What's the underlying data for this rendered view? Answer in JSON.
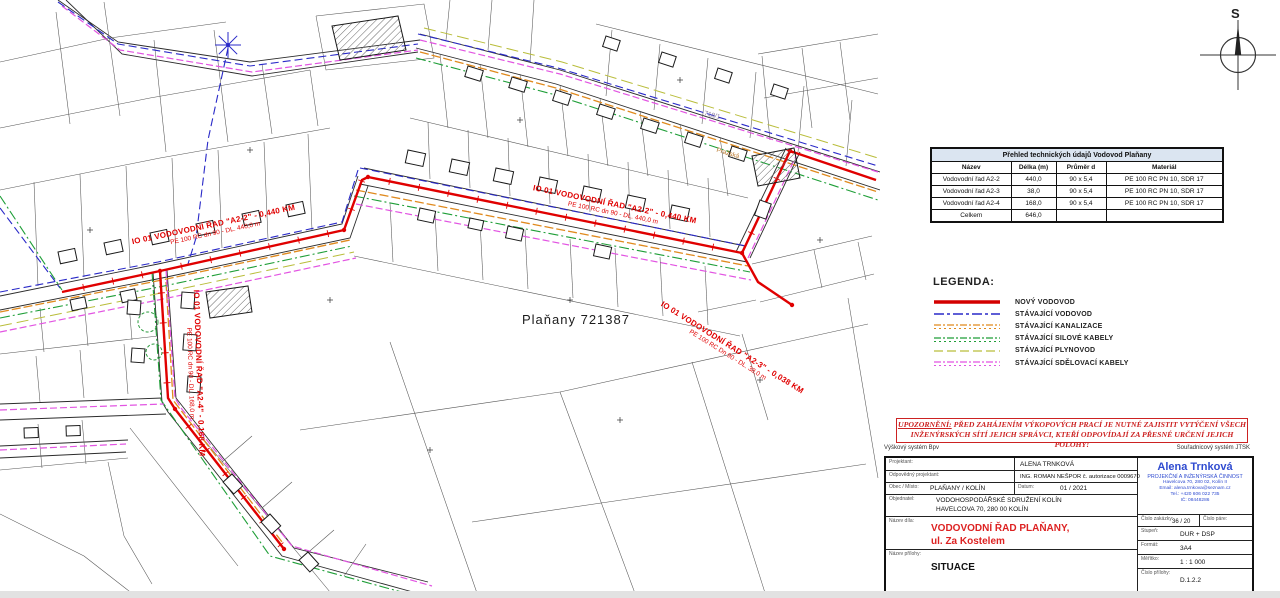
{
  "map": {
    "area_label": "Plaňany 721387",
    "street_label": "Pražská",
    "parcel_number": "718/1",
    "compass_letter": "S",
    "route_labels": [
      {
        "line1": "IO 01 VODOVODNÍ ŘAD \"A2-2\" - 0,440 KM",
        "line2": "PE 100 RC dn 90 - DL. 440,0 m"
      },
      {
        "line1": "IO 01 VODOVODNÍ ŘAD \"A2-2\" - 0,440 KM",
        "line2": "PE 100 RC dn 90 - DL. 440,0 m"
      },
      {
        "line1": "IO 01 VODOVODNÍ ŘAD \"A2-3\" - 0,038 KM",
        "line2": "PE 100 RC Dn 90 - DL. 38,0 m"
      },
      {
        "line1": "IO 01 VODOVODNÍ ŘAD \"A2-4\" - 0,168 KM",
        "line2": "PE 100 RC dn 90 - DL. 168,0 m"
      }
    ]
  },
  "tech_table": {
    "title": "Přehled technických údajů Vodovod Plaňany",
    "headers": [
      "Název",
      "Délka (m)",
      "Průměr d",
      "Materiál"
    ],
    "rows": [
      [
        "Vodovodní řad A2-2",
        "440,0",
        "90 x 5,4",
        "PE 100 RC PN 10, SDR 17"
      ],
      [
        "Vodovodní řad A2-3",
        "38,0",
        "90 x 5,4",
        "PE 100 RC PN 10, SDR 17"
      ],
      [
        "Vodovodní řad A2-4",
        "168,0",
        "90 x 5,4",
        "PE 100 RC PN 10, SDR 17"
      ],
      [
        "Celkem",
        "646,0",
        "",
        ""
      ]
    ]
  },
  "legend": {
    "title": "LEGENDA:",
    "items": [
      {
        "label": "NOVÝ VODOVOD",
        "color": "#d40000",
        "style": "solid"
      },
      {
        "label": "STÁVAJÍCÍ VODOVOD",
        "color": "#2929c8",
        "style": "dashdot"
      },
      {
        "label": "STÁVAJÍCÍ KANALIZACE",
        "color": "#e08a1e",
        "style": "ticked"
      },
      {
        "label": "STÁVAJÍCÍ SILOVÉ KABELY",
        "color": "#1e9e37",
        "style": "ticked"
      },
      {
        "label": "STÁVAJÍCÍ PLYNOVOD",
        "color": "#b9bd3a",
        "style": "dashed"
      },
      {
        "label": "STÁVAJÍCÍ SDĚLOVACÍ KABELY",
        "color": "#e254e2",
        "style": "ticked"
      }
    ]
  },
  "warning": {
    "heading": "UPOZORNĚNÍ:",
    "text1": "PŘED ZAHÁJENÍM VÝKOPOVÝCH PRACÍ JE NUTNÉ ZAJISTIT VYTÝČENÍ VŠECH",
    "text2": "INŽENÝRSKÝCH SÍTÍ JEJICH SPRÁVCI, KTEŘÍ ODPOVÍDAJÍ ZA PŘESNÉ URČENÍ JEJICH POLOHY!"
  },
  "coordinate_systems": {
    "height": "Výškový systém Bpv",
    "position": "Souřadnicový systém JTSK"
  },
  "title_block": {
    "labels": {
      "projektant": "Projektant:",
      "odpovedny_projektant": "Odpovědný projektant:",
      "obec": "Obec / Místo:",
      "datum": "Datum:",
      "objednatel": "Objednatel:",
      "nazev_dila": "Název díla:",
      "nazev_prilohy": "Název přílohy:",
      "cislo_zakazky": "Číslo zakázky:",
      "cislo_pare": "Číslo páre:",
      "stupen": "Stupeň:",
      "format": "Formát:",
      "meritko": "Měřítko:",
      "cislo_prilohy": "Číslo přílohy:"
    },
    "values": {
      "projektant": "ALENA TRNKOVÁ",
      "odpovedny_projektant": "ING. ROMAN NEŠPOR č. autorizace 0009670",
      "obec": "PLAŇANY / KOLÍN",
      "datum": "01 / 2021",
      "objednatel_1": "VODOHOSPODÁŘSKÉ SDRUŽENÍ KOLÍN",
      "objednatel_2": "HAVELCOVA 70, 280 00 KOLÍN",
      "nazev_dila_1": "VODOVODNÍ ŘAD PLAŇANY,",
      "nazev_dila_2": "ul. Za Kostelem",
      "nazev_prilohy": "SITUACE",
      "cislo_zakazky": "36 / 20",
      "cislo_pare": "",
      "stupen": "DUR + DSP",
      "format": "3A4",
      "meritko": "1 : 1 000",
      "cislo_prilohy": "D.1.2.2"
    },
    "company": {
      "name": "Alena Trnková",
      "subtitle": "PROJEKČNÍ A INŽENÝRSKÁ ČINNOST",
      "address": "Havelcova 70, 280 02, Kolín II",
      "email": "Email: alena.trnkova@seznam.cz",
      "phone": "Tel.: +420 606 022 735",
      "ic": "IČ: 08448286"
    }
  }
}
